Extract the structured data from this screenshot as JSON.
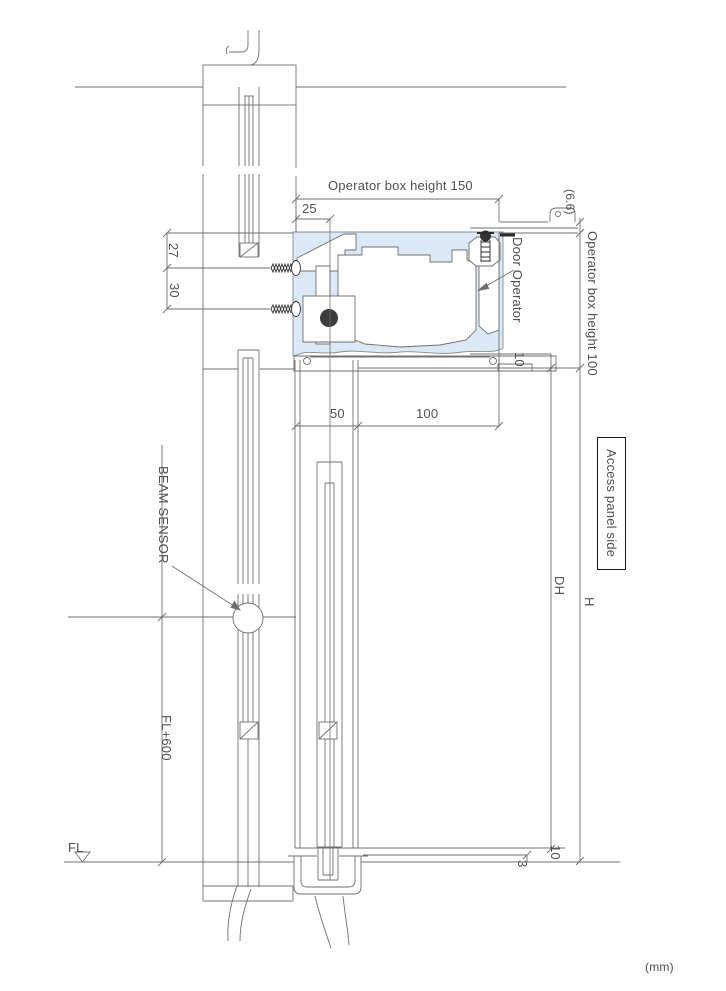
{
  "drawing": {
    "type": "vertical-section-detail-automatic-sliding-door",
    "unit_note": "(mm)",
    "colors": {
      "line": "#6f6f6f",
      "dark_hardware": "#2b2b2b",
      "operator_box_fill": "#dbe9f6",
      "text": "#4f4f4f",
      "background": "#ffffff"
    },
    "labels": {
      "op_box_h150": "Operator box height 150",
      "dim25": "25",
      "dim27": "27",
      "dim30": "30",
      "dim50": "50",
      "dim100": "100",
      "dim66": "(6.6)",
      "op_box_h100": "Operator box height 100",
      "door_operator": "Door Operator",
      "dim10_upper": "10",
      "access_panel": "Access panel side",
      "dim_dh": "DH",
      "dim_h": "H",
      "beam_sensor": "BEAM SENSOR",
      "fl_plus_600": "FL+600",
      "fl": "FL",
      "dim10_lower": "10",
      "dim3": "3",
      "unit": "(mm)"
    }
  }
}
